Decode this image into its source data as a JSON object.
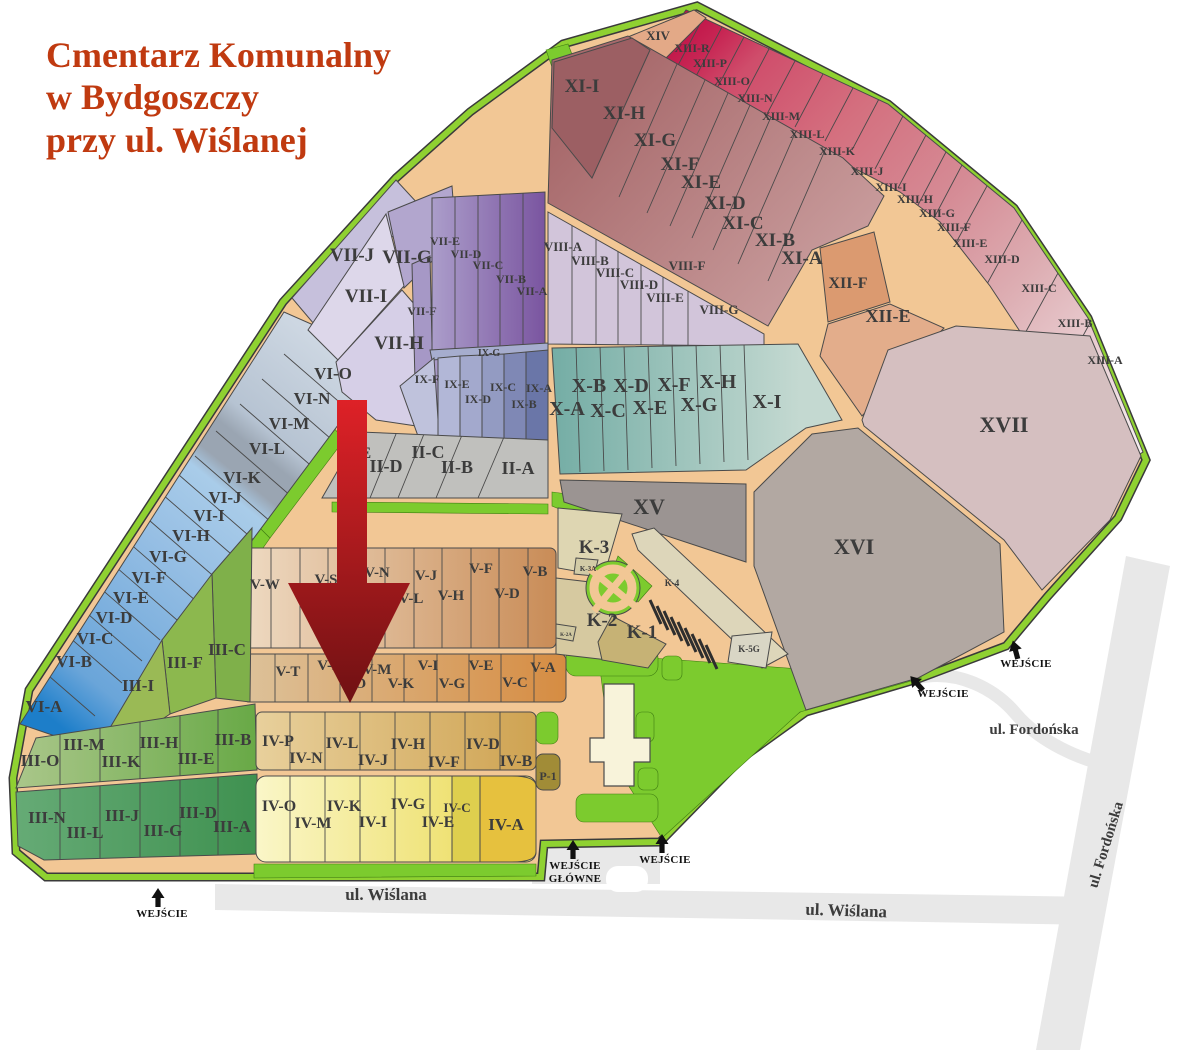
{
  "title": {
    "line1": "Cmentarz Komunalny",
    "line2": "w Bydgoszczy",
    "line3": "przy ul. Wiślanej"
  },
  "colors": {
    "title_text": "#c03a10",
    "label_text": "#3c3c3c",
    "entrance_text": "#111111",
    "arrow_top": "#de2127",
    "arrow_bottom": "#6f1113",
    "road_fill": "#f2c795",
    "border_green": "#8fd131",
    "street_road": "#e8e8e8"
  },
  "map": {
    "section_labels": [
      {
        "t": "XIV",
        "x": 658,
        "y": 40,
        "s": 13
      },
      {
        "t": "XIII-R",
        "x": 692,
        "y": 52,
        "s": 12
      },
      {
        "t": "XIII-P",
        "x": 710,
        "y": 67,
        "s": 12
      },
      {
        "t": "XIII-O",
        "x": 732,
        "y": 85,
        "s": 12
      },
      {
        "t": "XIII-N",
        "x": 755,
        "y": 102,
        "s": 12
      },
      {
        "t": "XIII-M",
        "x": 781,
        "y": 120,
        "s": 12
      },
      {
        "t": "XIII-L",
        "x": 807,
        "y": 138,
        "s": 12
      },
      {
        "t": "XIII-K",
        "x": 837,
        "y": 155,
        "s": 12
      },
      {
        "t": "XIII-J",
        "x": 867,
        "y": 175,
        "s": 12
      },
      {
        "t": "XIII-I",
        "x": 891,
        "y": 191,
        "s": 12
      },
      {
        "t": "XIII-H",
        "x": 915,
        "y": 203,
        "s": 12
      },
      {
        "t": "XIII-G",
        "x": 937,
        "y": 217,
        "s": 12
      },
      {
        "t": "XIII-F",
        "x": 954,
        "y": 231,
        "s": 12
      },
      {
        "t": "XIII-E",
        "x": 970,
        "y": 247,
        "s": 12
      },
      {
        "t": "XIII-D",
        "x": 1002,
        "y": 263,
        "s": 12
      },
      {
        "t": "XIII-C",
        "x": 1039,
        "y": 292,
        "s": 12
      },
      {
        "t": "XIII-B",
        "x": 1075,
        "y": 327,
        "s": 12
      },
      {
        "t": "XIII-A",
        "x": 1105,
        "y": 364,
        "s": 12
      },
      {
        "t": "XI-I",
        "x": 582,
        "y": 92,
        "s": 19
      },
      {
        "t": "XI-H",
        "x": 624,
        "y": 119,
        "s": 19
      },
      {
        "t": "XI-G",
        "x": 655,
        "y": 146,
        "s": 19
      },
      {
        "t": "XI-F",
        "x": 680,
        "y": 170,
        "s": 19
      },
      {
        "t": "XI-E",
        "x": 701,
        "y": 188,
        "s": 19
      },
      {
        "t": "XI-D",
        "x": 725,
        "y": 209,
        "s": 19
      },
      {
        "t": "XI-C",
        "x": 743,
        "y": 229,
        "s": 19
      },
      {
        "t": "XI-B",
        "x": 775,
        "y": 246,
        "s": 19
      },
      {
        "t": "XI-A",
        "x": 802,
        "y": 264,
        "s": 19
      },
      {
        "t": "XII-F",
        "x": 848,
        "y": 288,
        "s": 16
      },
      {
        "t": "XII-E",
        "x": 888,
        "y": 322,
        "s": 18
      },
      {
        "t": "XVII",
        "x": 1004,
        "y": 432,
        "s": 22
      },
      {
        "t": "XVI",
        "x": 854,
        "y": 554,
        "s": 22
      },
      {
        "t": "XV",
        "x": 649,
        "y": 514,
        "s": 22
      },
      {
        "t": "VII-J",
        "x": 352,
        "y": 261,
        "s": 19
      },
      {
        "t": "VII-G",
        "x": 407,
        "y": 263,
        "s": 19
      },
      {
        "t": "VII-I",
        "x": 366,
        "y": 302,
        "s": 19
      },
      {
        "t": "VII-H",
        "x": 399,
        "y": 349,
        "s": 19
      },
      {
        "t": "VII-F",
        "x": 422,
        "y": 315,
        "s": 12
      },
      {
        "t": "VII-E",
        "x": 445,
        "y": 245,
        "s": 12
      },
      {
        "t": "VII-D",
        "x": 466,
        "y": 258,
        "s": 12
      },
      {
        "t": "VII-C",
        "x": 488,
        "y": 269,
        "s": 12
      },
      {
        "t": "VII-B",
        "x": 511,
        "y": 283,
        "s": 12
      },
      {
        "t": "VII-A",
        "x": 532,
        "y": 295,
        "s": 12
      },
      {
        "t": "VIII-A",
        "x": 563,
        "y": 251,
        "s": 13
      },
      {
        "t": "VIII-B",
        "x": 590,
        "y": 265,
        "s": 13
      },
      {
        "t": "VIII-C",
        "x": 615,
        "y": 277,
        "s": 13
      },
      {
        "t": "VIII-D",
        "x": 639,
        "y": 289,
        "s": 13
      },
      {
        "t": "VIII-E",
        "x": 665,
        "y": 302,
        "s": 13
      },
      {
        "t": "VIII-F",
        "x": 687,
        "y": 270,
        "s": 13
      },
      {
        "t": "VIII-G",
        "x": 719,
        "y": 314,
        "s": 13
      },
      {
        "t": "IX-G",
        "x": 489,
        "y": 356,
        "s": 10
      },
      {
        "t": "IX-F",
        "x": 427,
        "y": 383,
        "s": 12
      },
      {
        "t": "IX-E",
        "x": 457,
        "y": 388,
        "s": 12
      },
      {
        "t": "IX-D",
        "x": 478,
        "y": 403,
        "s": 12
      },
      {
        "t": "IX-C",
        "x": 503,
        "y": 391,
        "s": 12
      },
      {
        "t": "IX-B",
        "x": 524,
        "y": 408,
        "s": 12
      },
      {
        "t": "IX-A",
        "x": 539,
        "y": 392,
        "s": 12
      },
      {
        "t": "X-B",
        "x": 589,
        "y": 392,
        "s": 20
      },
      {
        "t": "X-D",
        "x": 631,
        "y": 392,
        "s": 20
      },
      {
        "t": "X-F",
        "x": 674,
        "y": 391,
        "s": 20
      },
      {
        "t": "X-H",
        "x": 718,
        "y": 388,
        "s": 20
      },
      {
        "t": "X-A",
        "x": 567,
        "y": 415,
        "s": 20
      },
      {
        "t": "X-C",
        "x": 608,
        "y": 417,
        "s": 20
      },
      {
        "t": "X-E",
        "x": 650,
        "y": 414,
        "s": 20
      },
      {
        "t": "X-G",
        "x": 699,
        "y": 411,
        "s": 20
      },
      {
        "t": "X-I",
        "x": 767,
        "y": 408,
        "s": 20
      },
      {
        "t": "II-E",
        "x": 357,
        "y": 458,
        "s": 16
      },
      {
        "t": "II-D",
        "x": 386,
        "y": 472,
        "s": 18
      },
      {
        "t": "II-C",
        "x": 428,
        "y": 458,
        "s": 18
      },
      {
        "t": "II-B",
        "x": 457,
        "y": 473,
        "s": 18
      },
      {
        "t": "II-A",
        "x": 518,
        "y": 474,
        "s": 18
      },
      {
        "t": "VI-O",
        "x": 333,
        "y": 379,
        "s": 17
      },
      {
        "t": "VI-N",
        "x": 312,
        "y": 404,
        "s": 17
      },
      {
        "t": "VI-M",
        "x": 289,
        "y": 429,
        "s": 17
      },
      {
        "t": "VI-L",
        "x": 267,
        "y": 454,
        "s": 17
      },
      {
        "t": "VI-K",
        "x": 242,
        "y": 483,
        "s": 17
      },
      {
        "t": "VI-J",
        "x": 225,
        "y": 503,
        "s": 17
      },
      {
        "t": "VI-I",
        "x": 209,
        "y": 521,
        "s": 17
      },
      {
        "t": "VI-H",
        "x": 191,
        "y": 541,
        "s": 17
      },
      {
        "t": "VI-G",
        "x": 168,
        "y": 562,
        "s": 17
      },
      {
        "t": "VI-F",
        "x": 149,
        "y": 583,
        "s": 17
      },
      {
        "t": "VI-E",
        "x": 131,
        "y": 603,
        "s": 17
      },
      {
        "t": "VI-D",
        "x": 114,
        "y": 623,
        "s": 17
      },
      {
        "t": "VI-C",
        "x": 95,
        "y": 644,
        "s": 17
      },
      {
        "t": "VI-B",
        "x": 74,
        "y": 667,
        "s": 17
      },
      {
        "t": "VI-A",
        "x": 44,
        "y": 712,
        "s": 17
      },
      {
        "t": "III-C",
        "x": 227,
        "y": 655,
        "s": 17
      },
      {
        "t": "III-F",
        "x": 185,
        "y": 668,
        "s": 17
      },
      {
        "t": "III-I",
        "x": 138,
        "y": 691,
        "s": 17
      },
      {
        "t": "III-O",
        "x": 40,
        "y": 766,
        "s": 17
      },
      {
        "t": "III-M",
        "x": 84,
        "y": 750,
        "s": 17
      },
      {
        "t": "III-K",
        "x": 121,
        "y": 767,
        "s": 17
      },
      {
        "t": "III-H",
        "x": 159,
        "y": 748,
        "s": 17
      },
      {
        "t": "III-E",
        "x": 196,
        "y": 764,
        "s": 17
      },
      {
        "t": "III-B",
        "x": 233,
        "y": 745,
        "s": 17
      },
      {
        "t": "III-N",
        "x": 47,
        "y": 823,
        "s": 17
      },
      {
        "t": "III-L",
        "x": 85,
        "y": 838,
        "s": 17
      },
      {
        "t": "III-J",
        "x": 122,
        "y": 821,
        "s": 17
      },
      {
        "t": "III-G",
        "x": 163,
        "y": 836,
        "s": 17
      },
      {
        "t": "III-D",
        "x": 198,
        "y": 818,
        "s": 17
      },
      {
        "t": "III-A",
        "x": 232,
        "y": 832,
        "s": 17
      },
      {
        "t": "V-W",
        "x": 265,
        "y": 589,
        "s": 15
      },
      {
        "t": "V-S",
        "x": 326,
        "y": 584,
        "s": 15
      },
      {
        "t": "V-N",
        "x": 377,
        "y": 577,
        "s": 15
      },
      {
        "t": "V-L",
        "x": 411,
        "y": 603,
        "s": 15
      },
      {
        "t": "V-J",
        "x": 426,
        "y": 580,
        "s": 15
      },
      {
        "t": "V-H",
        "x": 451,
        "y": 600,
        "s": 15
      },
      {
        "t": "V-F",
        "x": 481,
        "y": 573,
        "s": 15
      },
      {
        "t": "V-D",
        "x": 507,
        "y": 598,
        "s": 15
      },
      {
        "t": "V-B",
        "x": 535,
        "y": 576,
        "s": 15
      },
      {
        "t": "V-T",
        "x": 288,
        "y": 676,
        "s": 15
      },
      {
        "t": "V-R",
        "x": 330,
        "y": 670,
        "s": 15
      },
      {
        "t": "V-O",
        "x": 353,
        "y": 688,
        "s": 15
      },
      {
        "t": "V-M",
        "x": 377,
        "y": 674,
        "s": 15
      },
      {
        "t": "V-K",
        "x": 401,
        "y": 688,
        "s": 15
      },
      {
        "t": "V-I",
        "x": 428,
        "y": 670,
        "s": 15
      },
      {
        "t": "V-G",
        "x": 452,
        "y": 688,
        "s": 15
      },
      {
        "t": "V-E",
        "x": 481,
        "y": 670,
        "s": 15
      },
      {
        "t": "V-C",
        "x": 515,
        "y": 687,
        "s": 15
      },
      {
        "t": "V-A",
        "x": 543,
        "y": 672,
        "s": 15
      },
      {
        "t": "K-3",
        "x": 594,
        "y": 553,
        "s": 19
      },
      {
        "t": "K-3A",
        "x": 588,
        "y": 571,
        "s": 7
      },
      {
        "t": "K-4",
        "x": 672,
        "y": 586,
        "s": 9
      },
      {
        "t": "K-2",
        "x": 602,
        "y": 626,
        "s": 19
      },
      {
        "t": "K-1",
        "x": 642,
        "y": 638,
        "s": 19
      },
      {
        "t": "K-2A",
        "x": 566,
        "y": 636,
        "s": 5
      },
      {
        "t": "K-5G",
        "x": 749,
        "y": 652,
        "s": 9
      },
      {
        "t": "IV-P",
        "x": 278,
        "y": 746,
        "s": 16
      },
      {
        "t": "IV-N",
        "x": 306,
        "y": 763,
        "s": 16
      },
      {
        "t": "IV-L",
        "x": 342,
        "y": 748,
        "s": 16
      },
      {
        "t": "IV-J",
        "x": 373,
        "y": 765,
        "s": 16
      },
      {
        "t": "IV-H",
        "x": 408,
        "y": 749,
        "s": 16
      },
      {
        "t": "IV-F",
        "x": 444,
        "y": 767,
        "s": 16
      },
      {
        "t": "IV-D",
        "x": 483,
        "y": 749,
        "s": 16
      },
      {
        "t": "IV-B",
        "x": 516,
        "y": 766,
        "s": 16
      },
      {
        "t": "IV-O",
        "x": 279,
        "y": 811,
        "s": 16
      },
      {
        "t": "IV-M",
        "x": 313,
        "y": 828,
        "s": 16
      },
      {
        "t": "IV-K",
        "x": 344,
        "y": 811,
        "s": 16
      },
      {
        "t": "IV-I",
        "x": 373,
        "y": 827,
        "s": 16
      },
      {
        "t": "IV-G",
        "x": 408,
        "y": 809,
        "s": 16
      },
      {
        "t": "IV-E",
        "x": 438,
        "y": 827,
        "s": 16
      },
      {
        "t": "IV-C",
        "x": 457,
        "y": 812,
        "s": 13
      },
      {
        "t": "IV-A",
        "x": 506,
        "y": 830,
        "s": 17
      },
      {
        "t": "P-1",
        "x": 548,
        "y": 780,
        "s": 12
      }
    ],
    "street_labels": [
      {
        "t": "ul. Wiślana",
        "x": 386,
        "y": 900,
        "s": 17,
        "r": 0
      },
      {
        "t": "ul. Wiślana",
        "x": 846,
        "y": 916,
        "s": 17,
        "r": 2
      },
      {
        "t": "ul. Fordońska",
        "x": 1034,
        "y": 734,
        "s": 15,
        "r": 0
      },
      {
        "t": "ul. Fordońska",
        "x": 1110,
        "y": 846,
        "s": 15,
        "r": -73
      }
    ],
    "entrance_labels": [
      {
        "t": "WEJŚCIE",
        "x": 162,
        "y": 917,
        "ax": 158,
        "ay": 904,
        "r": 0
      },
      {
        "t": "WEJŚCIE",
        "t2": "GŁÓWNE",
        "x": 575,
        "y": 869,
        "ax": 573,
        "ay": 856,
        "r": 0
      },
      {
        "t": "WEJŚCIE",
        "x": 665,
        "y": 863,
        "ax": 662,
        "ay": 850,
        "r": 0
      },
      {
        "t": "WEJŚCIE",
        "x": 1026,
        "y": 667,
        "ax": 1017,
        "ay": 656,
        "r": -15
      },
      {
        "t": "WEJŚCIE",
        "x": 943,
        "y": 697,
        "ax": 921,
        "ay": 688,
        "r": -42
      }
    ]
  }
}
